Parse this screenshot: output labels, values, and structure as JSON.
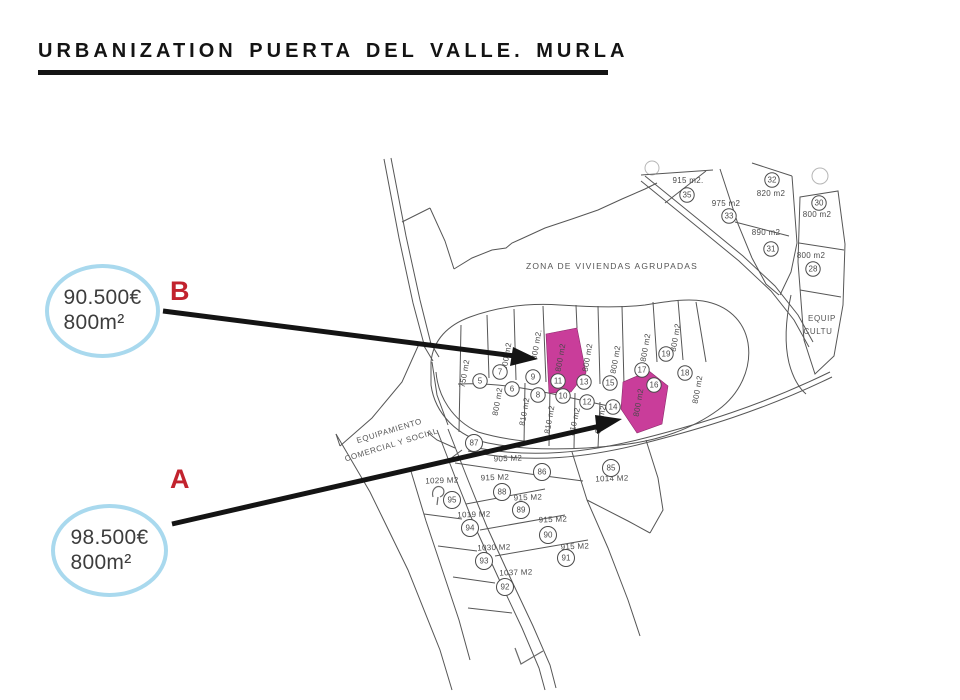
{
  "title": {
    "text": "URBANIZATION PUERTA DEL VALLE. MURLA"
  },
  "annotations": {
    "items": [
      {
        "letter": "B",
        "price": "90.500€",
        "area": "800m²",
        "target_plot": "11"
      },
      {
        "letter": "A",
        "price": "98.500€",
        "area": "800m²",
        "target_plot": "16"
      }
    ]
  },
  "colors": {
    "highlight_pink": "#c93d9a",
    "oval_stroke": "#a9d9ee",
    "letter_red": "#c2232e",
    "map_line": "#565656"
  },
  "map": {
    "zone_label": "ZONA DE VIVIENDAS AGRUPADAS",
    "equip_left_lines": [
      "EQUIPAMIENTO",
      "COMERCIAL Y SOCIAL"
    ],
    "equip_right_lines": [
      "EQUIP",
      "CULTU"
    ],
    "highlight_color": "#c93d9a",
    "highlighted_plots": [
      "11",
      "16"
    ],
    "plots": [
      {
        "n": "35",
        "cx": 687,
        "cy": 195,
        "area": "915 m2.",
        "ax": 688,
        "ay": 183,
        "ar": 0
      },
      {
        "n": "33",
        "cx": 729,
        "cy": 216,
        "area": "975 m2",
        "ax": 726,
        "ay": 206,
        "ar": 0
      },
      {
        "n": "32",
        "cx": 772,
        "cy": 180,
        "area": "820 m2",
        "ax": 771,
        "ay": 196,
        "ar": 0
      },
      {
        "n": "31",
        "cx": 771,
        "cy": 249,
        "area": "890 m2",
        "ax": 766,
        "ay": 235,
        "ar": 0
      },
      {
        "n": "30",
        "cx": 819,
        "cy": 203,
        "area": "800 m2",
        "ax": 817,
        "ay": 217,
        "ar": 0
      },
      {
        "n": "28",
        "cx": 813,
        "cy": 269,
        "area": "800 m2",
        "ax": 811,
        "ay": 258,
        "ar": 0
      },
      {
        "n": "5",
        "cx": 480,
        "cy": 381,
        "area": "750 m2",
        "ax": 467,
        "ay": 374,
        "ar": -80
      },
      {
        "n": "7",
        "cx": 500,
        "cy": 372,
        "area": "800 m2",
        "ax": 509,
        "ay": 357,
        "ar": -80
      },
      {
        "n": "9",
        "cx": 533,
        "cy": 377,
        "area": "800 m2.",
        "ax": 539,
        "ay": 345,
        "ar": -80
      },
      {
        "n": "11",
        "cx": 558,
        "cy": 381,
        "area": "800 m2",
        "ax": 563,
        "ay": 358,
        "ar": -80,
        "hl": true
      },
      {
        "n": "13",
        "cx": 584,
        "cy": 382,
        "area": "800 m2",
        "ax": 590,
        "ay": 358,
        "ar": -80
      },
      {
        "n": "15",
        "cx": 610,
        "cy": 383,
        "area": "800 m2",
        "ax": 618,
        "ay": 360,
        "ar": -80
      },
      {
        "n": "17",
        "cx": 642,
        "cy": 370,
        "area": "800 m2",
        "ax": 648,
        "ay": 348,
        "ar": -80
      },
      {
        "n": "19",
        "cx": 666,
        "cy": 354,
        "area": "800 m2",
        "ax": 678,
        "ay": 338,
        "ar": -80
      },
      {
        "n": "18",
        "cx": 685,
        "cy": 373,
        "area": "800 m2",
        "ax": 700,
        "ay": 390,
        "ar": -80
      },
      {
        "n": "6",
        "cx": 512,
        "cy": 389,
        "area": "800 m2",
        "ax": 500,
        "ay": 402,
        "ar": -80
      },
      {
        "n": "8",
        "cx": 538,
        "cy": 395,
        "area": "810 m2",
        "ax": 527,
        "ay": 412,
        "ar": -80
      },
      {
        "n": "10",
        "cx": 563,
        "cy": 396,
        "area": "810 m2",
        "ax": 552,
        "ay": 420,
        "ar": -80
      },
      {
        "n": "12",
        "cx": 587,
        "cy": 402,
        "area": "810 m2",
        "ax": 577,
        "ay": 422,
        "ar": -78
      },
      {
        "n": "14",
        "cx": 613,
        "cy": 407,
        "area": "800 m2",
        "ax": 603,
        "ay": 420,
        "ar": -78
      },
      {
        "n": "16",
        "cx": 654,
        "cy": 385,
        "area": "800 m2",
        "ax": 641,
        "ay": 403,
        "ar": -80,
        "hl": true
      },
      {
        "n": "87",
        "cx": 474,
        "cy": 443,
        "area": "",
        "ax": 0,
        "ay": 0,
        "ar": 0,
        "r": 8.5
      },
      {
        "n": "86",
        "cx": 542,
        "cy": 472,
        "area": "905 M2",
        "ax": 508,
        "ay": 461,
        "ar": -2,
        "r": 8.5
      },
      {
        "n": "85",
        "cx": 611,
        "cy": 468,
        "area": "1014 M2",
        "ax": 612,
        "ay": 481,
        "ar": -2,
        "r": 8.5
      },
      {
        "n": "88",
        "cx": 502,
        "cy": 492,
        "area": "915 M2",
        "ax": 495,
        "ay": 480,
        "ar": -2,
        "r": 8.5
      },
      {
        "n": "95",
        "cx": 452,
        "cy": 500,
        "area": "1029 M2",
        "ax": 442,
        "ay": 483,
        "ar": -2,
        "r": 8.5
      },
      {
        "n": "89",
        "cx": 521,
        "cy": 510,
        "area": "915 M2",
        "ax": 528,
        "ay": 500,
        "ar": -2,
        "r": 8.5
      },
      {
        "n": "94",
        "cx": 470,
        "cy": 528,
        "area": "1019 M2",
        "ax": 474,
        "ay": 517,
        "ar": -2,
        "r": 8.5
      },
      {
        "n": "90",
        "cx": 548,
        "cy": 535,
        "area": "915 M2",
        "ax": 553,
        "ay": 522,
        "ar": -2,
        "r": 8.5
      },
      {
        "n": "93",
        "cx": 484,
        "cy": 561,
        "area": "1030 M2",
        "ax": 494,
        "ay": 550,
        "ar": -2,
        "r": 8.5
      },
      {
        "n": "91",
        "cx": 566,
        "cy": 558,
        "area": "915 M2",
        "ax": 575,
        "ay": 549,
        "ar": -2,
        "r": 8.5
      },
      {
        "n": "92",
        "cx": 505,
        "cy": 587,
        "area": "1037 M2",
        "ax": 516,
        "ay": 575,
        "ar": -2,
        "r": 8.5
      }
    ]
  }
}
